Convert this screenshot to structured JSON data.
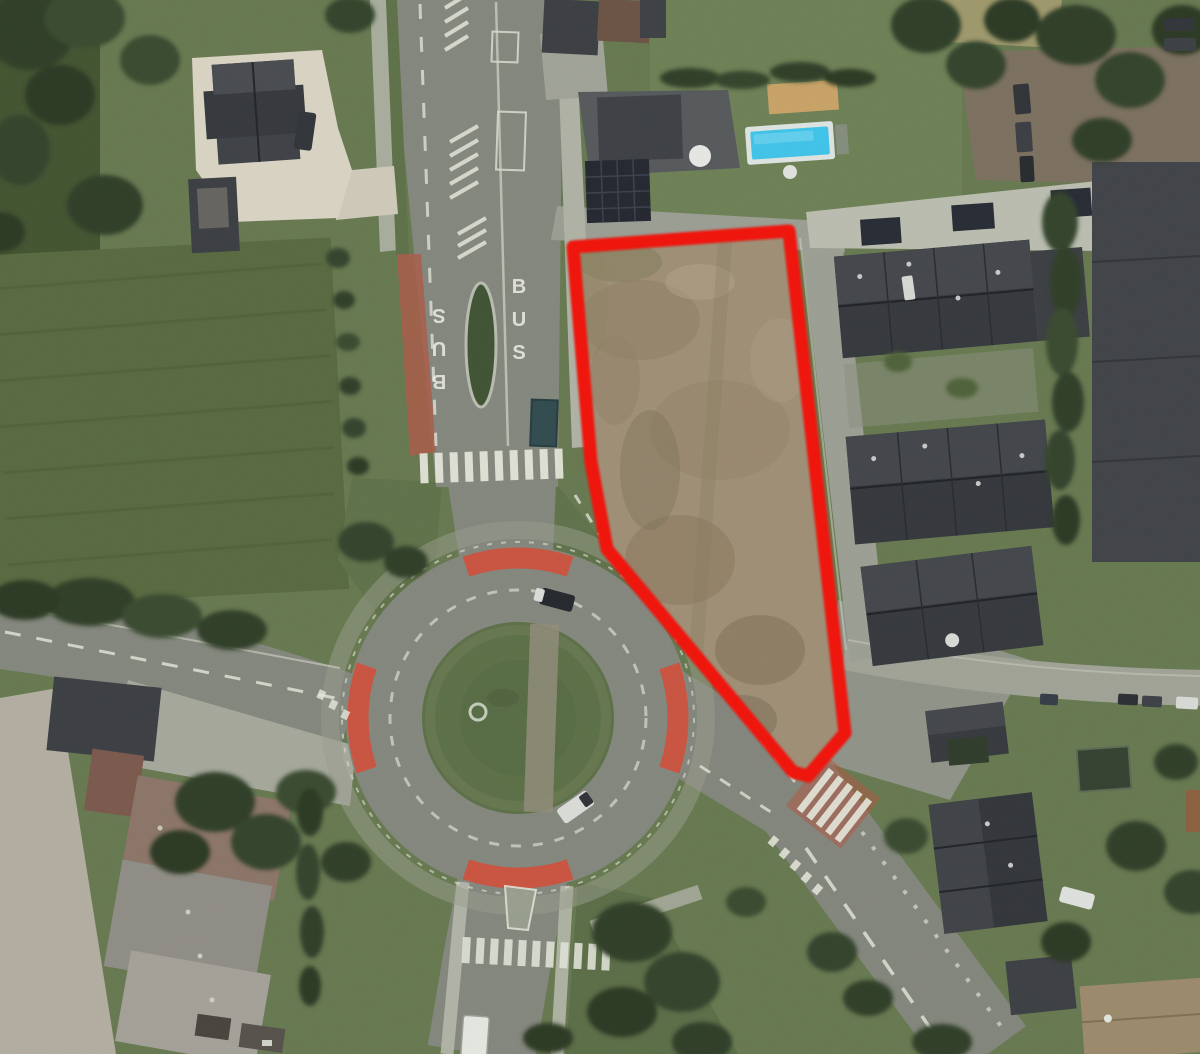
{
  "scene": {
    "type": "aerial-satellite-photo",
    "description": "Satellite view of a village roundabout junction. A vacant brown building plot next to the roundabout is outlined with a thick red boundary. Row houses with dark roofs lie east of the plot, a villa with a swimming pool to the north, green fields to the west and farm buildings to the south-west.",
    "highlight": {
      "label": "outlined-parcel",
      "outline_color": "#ee1509",
      "shape": "polygon"
    },
    "road_markings": {
      "bus_lane_left": "BUS",
      "bus_lane_right": "BUS"
    },
    "features": {
      "roundabout": "roundabout with grass centre island and red cycle-crossing arcs",
      "pool": "blue swimming pool",
      "crosswalks": "white zebra crossings",
      "parcel": "bare brown earth plot"
    },
    "colors": {
      "parcel_dirt": "#9e8e75",
      "grass": "#66784f",
      "asphalt": "#83867c",
      "cycle_crossing_red": "#cf4f3a",
      "pool_water": "#3ec3e8",
      "parcel_outline": "#ee1509"
    }
  }
}
